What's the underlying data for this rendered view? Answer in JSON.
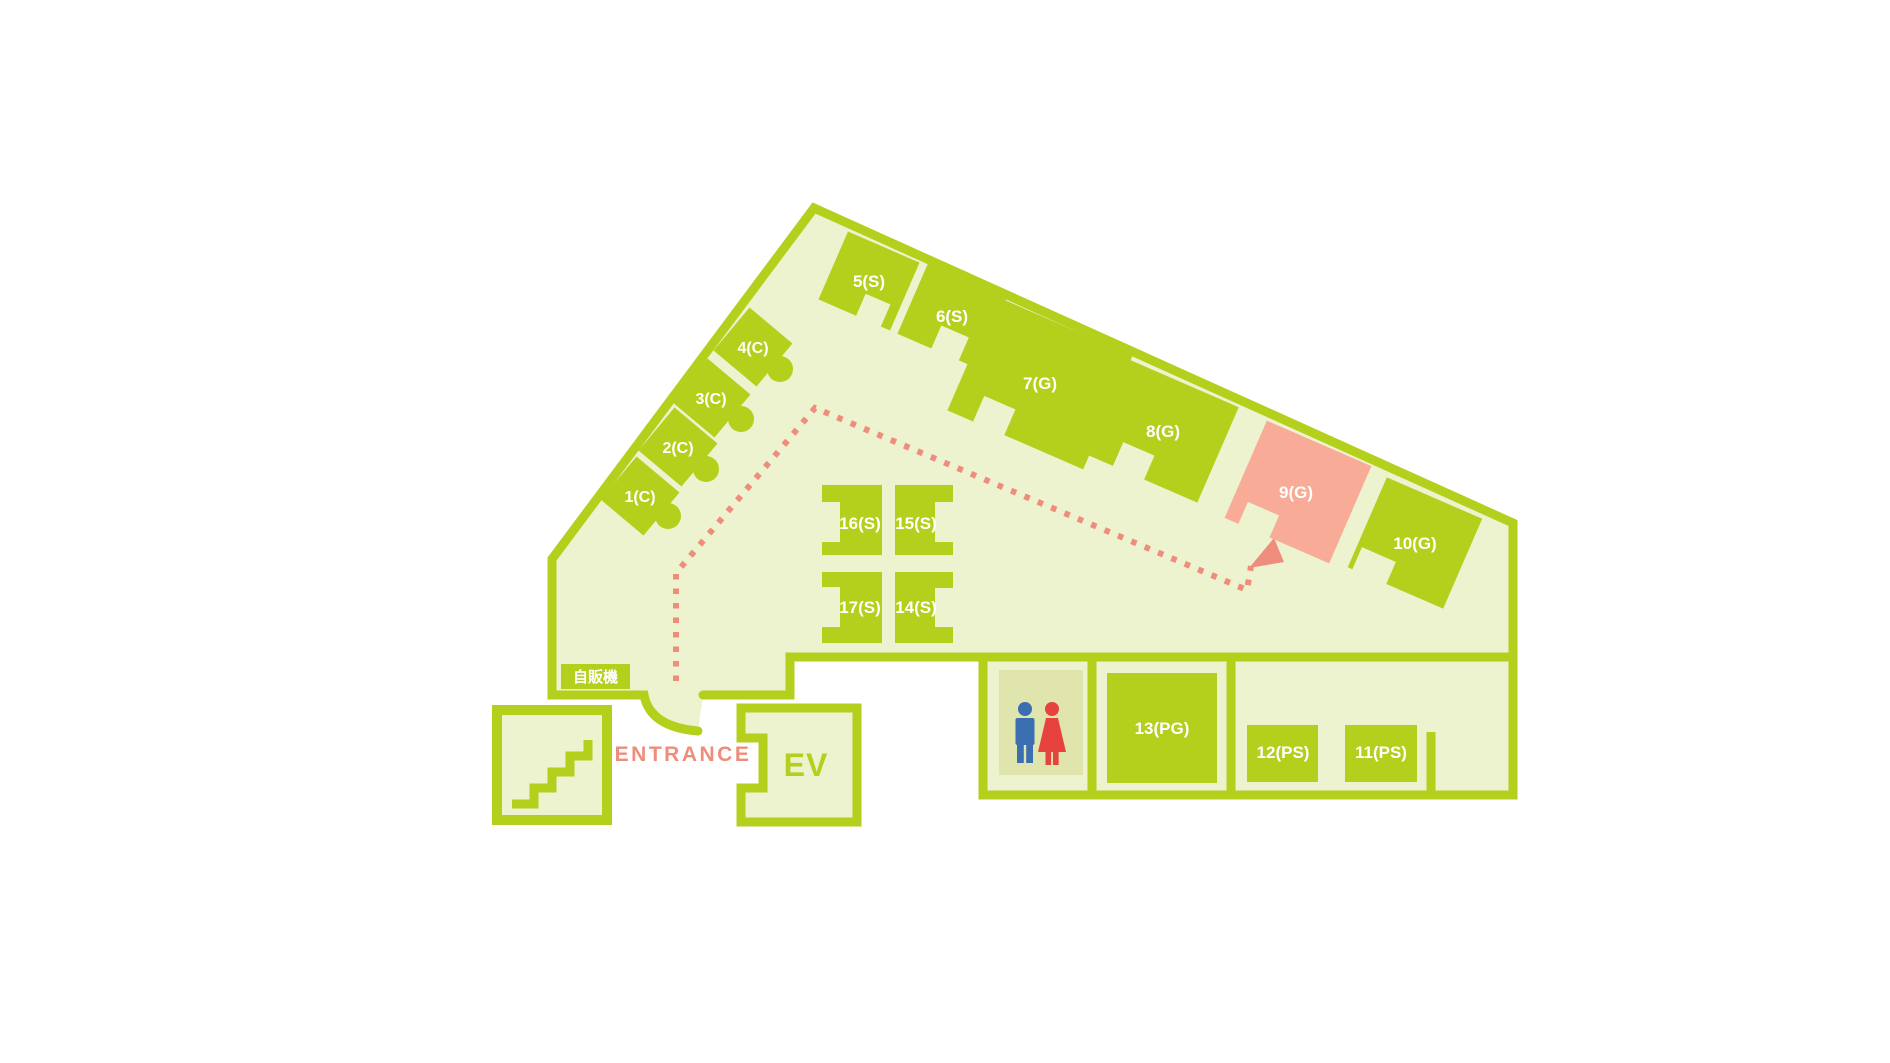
{
  "map": {
    "title_hint": "floor-guide-map",
    "colors": {
      "wall_green": "#b5cf1d",
      "floor_light": "#edf2cf",
      "room_green": "#b5cf1d",
      "highlight_pink": "#f8ab97",
      "route_coral": "#ee8d7c",
      "restroom_bg": "#dfe5ad",
      "male_blue": "#3c6fb2",
      "female_red": "#e8423e",
      "label_white": "#ffffff"
    },
    "rooms": [
      {
        "id": "1c",
        "label": "1(C)",
        "type": "C"
      },
      {
        "id": "2c",
        "label": "2(C)",
        "type": "C"
      },
      {
        "id": "3c",
        "label": "3(C)",
        "type": "C"
      },
      {
        "id": "4c",
        "label": "4(C)",
        "type": "C"
      },
      {
        "id": "5s",
        "label": "5(S)",
        "type": "S"
      },
      {
        "id": "6s",
        "label": "6(S)",
        "type": "S"
      },
      {
        "id": "7g",
        "label": "7(G)",
        "type": "G"
      },
      {
        "id": "8g",
        "label": "8(G)",
        "type": "G"
      },
      {
        "id": "9g",
        "label": "9(G)",
        "type": "G",
        "highlighted": true
      },
      {
        "id": "10g",
        "label": "10(G)",
        "type": "G"
      },
      {
        "id": "11ps",
        "label": "11(PS)",
        "type": "PS"
      },
      {
        "id": "12ps",
        "label": "12(PS)",
        "type": "PS"
      },
      {
        "id": "13pg",
        "label": "13(PG)",
        "type": "PG"
      },
      {
        "id": "14s",
        "label": "14(S)",
        "type": "S"
      },
      {
        "id": "15s",
        "label": "15(S)",
        "type": "S"
      },
      {
        "id": "16s",
        "label": "16(S)",
        "type": "S"
      },
      {
        "id": "17s",
        "label": "17(S)",
        "type": "S"
      }
    ],
    "labels": {
      "entrance": "ENTRANCE",
      "elevator": "EV",
      "vending_machine": "自販機"
    },
    "route": {
      "destination": "9(G)",
      "style": "dotted",
      "color": "#ee8d7c"
    },
    "icons": [
      "stairs-icon",
      "male-icon",
      "female-icon",
      "route-arrow-icon"
    ]
  }
}
